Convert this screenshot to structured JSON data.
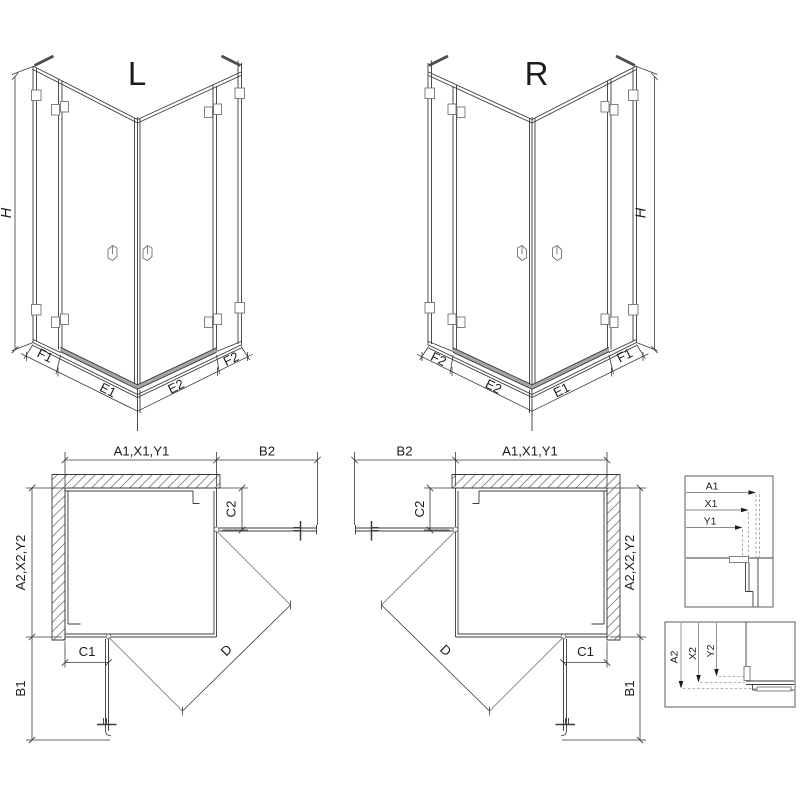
{
  "drawing": {
    "type_note": "corner shower enclosure technical drawing, left and right variants",
    "iso_left": {
      "title": "L",
      "height": "H",
      "bottom_left": [
        "F1",
        "E1"
      ],
      "bottom_right": [
        "E2",
        "F2"
      ]
    },
    "iso_right": {
      "title": "R",
      "height": "H",
      "bottom_left": [
        "F2",
        "E2"
      ],
      "bottom_right": [
        "E1",
        "F1"
      ]
    },
    "plan_left": {
      "width": "A1,X1,Y1",
      "door_top": "B2",
      "depth": "A2,X2,Y2",
      "door_side": "B1",
      "fixed_top": "C2",
      "fixed_side": "C1",
      "diagonal": "D"
    },
    "plan_right": {
      "width": "A1,X1,Y1",
      "door_top": "B2",
      "depth": "A2,X2,Y2",
      "door_side": "B1",
      "fixed_top": "C2",
      "fixed_side": "C1",
      "diagonal": "D"
    },
    "detail_top": {
      "d1": "A1",
      "d2": "X1",
      "d3": "Y1"
    },
    "detail_bottom": {
      "d1": "A2",
      "d2": "X2",
      "d3": "Y2"
    }
  },
  "colors": {
    "line": "#3a3a3a",
    "light_line": "#8a8a8a",
    "hatch": "#7d7d7d",
    "threshold": "#a6a6a6",
    "text": "#1c1c1c",
    "background": "#ffffff"
  }
}
